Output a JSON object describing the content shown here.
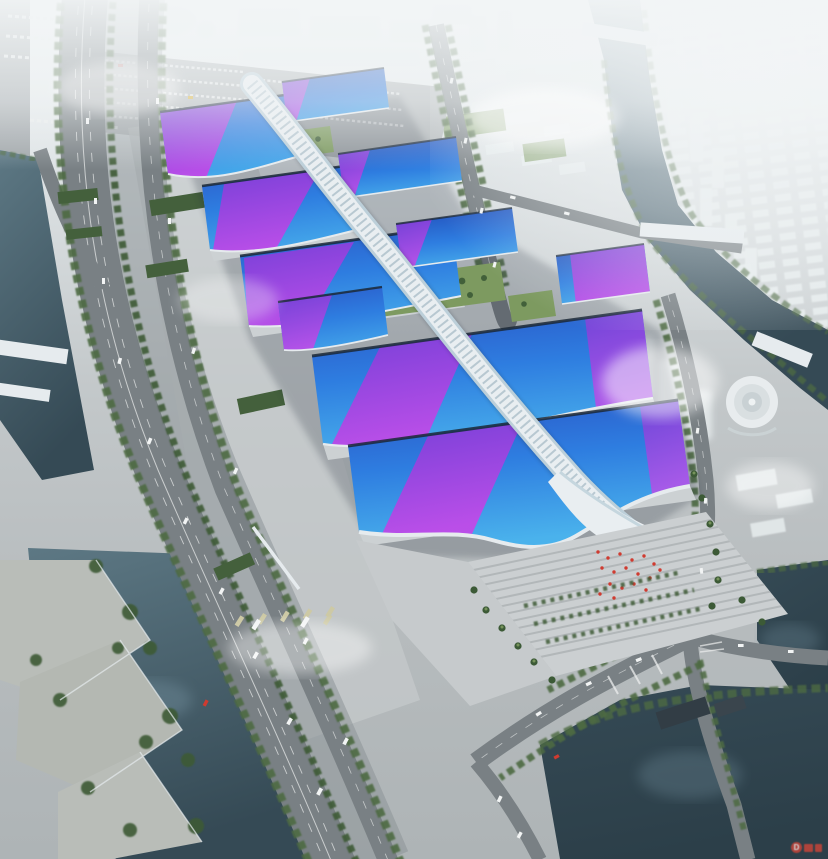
{
  "scene": {
    "type": "aerial-architectural-rendering",
    "subject": "riverside exhibition and convention center complex",
    "description": "Bird's-eye rendering of a huge exhibition center: two rows of wavy blue roofs with magenta ribbons flank a white serpentine central canopy, with a south entrance plaza, surrounding highways, canals, bridges and a foggy white city skyline"
  },
  "halls": {
    "west_count": 6,
    "east_count": 4,
    "roof_style": "blue-gradient-with-magenta-ribbons"
  },
  "features": [
    "city-skyline-in-fog",
    "northwest-parking-lot",
    "truck-parking-strip",
    "exhibition-halls-west",
    "exhibition-halls-east",
    "central-serpentine-canopy",
    "green-courtyards",
    "entrance-wave-canopy",
    "grand-stair-plaza",
    "red-flag-display",
    "palm-trees",
    "elevated-highway",
    "bus-depot",
    "east-avenue",
    "riverside-curved-road",
    "round-building",
    "left-canal",
    "right-canal",
    "south-lake",
    "waterfront-park",
    "bridges",
    "watermark"
  ],
  "colors": {
    "fog": "#f2f5f6",
    "ground": "#b7bcbe",
    "ground_light": "#c6cacc",
    "parking": "#b2b7b9",
    "plaza": "#cbcfd1",
    "plaza_line": "#b2b7b9",
    "road": "#8d9497",
    "road_dark": "#798084",
    "road_line": "#eceeee",
    "city": "#e7edee",
    "city_edge": "#ccd5d7",
    "water_river": "#5d7884",
    "water_light": "#6c8795",
    "water_dark": "#354a55",
    "water_deep": "#2c3f49",
    "green": "#4e6b42",
    "green_dark": "#3c5a36",
    "lawn": "#7d9a60",
    "roof_green": "#44603c",
    "hall_deep": "#2a50c2",
    "hall_deep2": "#1f3fae",
    "hall_mid": "#2e7de0",
    "hall_cyan": "#4ab2ec",
    "ribbon_hot": "#c04ae8",
    "ribbon_deep": "#7c3ed8",
    "eave": "#1b2836",
    "trim": "#e6ebee",
    "spine": "#e9eef1",
    "spine_shade": "#bccfd9",
    "spine_grid": "#8fa9b6",
    "flag_red": "#cf3b30",
    "bus": "#cdc9a5",
    "vehicle": "#f2f4f4",
    "watermark": "#cf4438"
  },
  "watermark": {
    "symbol": "D"
  }
}
